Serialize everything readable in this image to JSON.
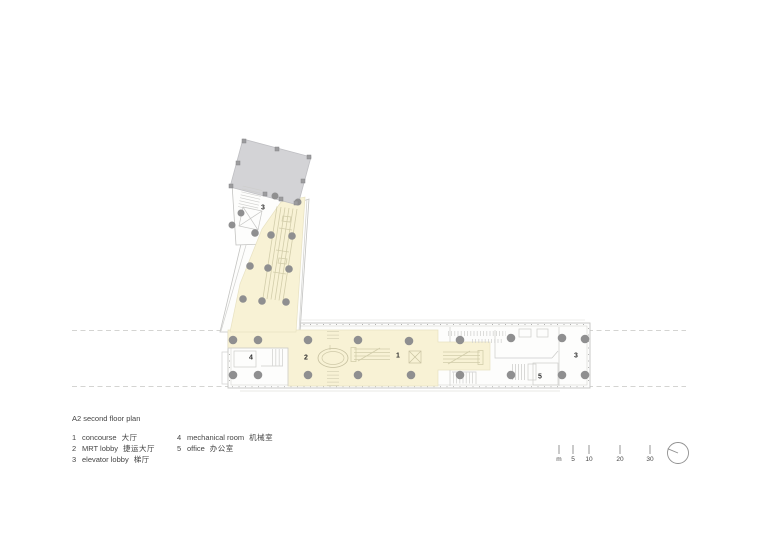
{
  "legend": {
    "title": "A2 second floor plan",
    "columns": [
      {
        "items": [
          {
            "num": "1",
            "en": "concourse",
            "zh": "大厅"
          },
          {
            "num": "2",
            "en": "MRT lobby",
            "zh": "捷运大厅"
          },
          {
            "num": "3",
            "en": "elevator lobby",
            "zh": "梯厅"
          }
        ]
      },
      {
        "items": [
          {
            "num": "4",
            "en": "mechanical room",
            "zh": "机械室"
          },
          {
            "num": "5",
            "en": "office",
            "zh": "办公室"
          }
        ]
      }
    ]
  },
  "plan": {
    "room_labels": {
      "concourse": "1",
      "mrt_lobby": "2",
      "elevator_lobby": "3",
      "mechanical_room": "4",
      "office": "5"
    },
    "colors": {
      "concourse_fill": "#f8f2d5",
      "roof_fill": "#d3d3d6",
      "column": "#8f8f90",
      "wall_line": "#c3c3c1",
      "detail_line": "#d2cdaa",
      "dashed_line": "#c6c6c4"
    }
  },
  "scale_bar": {
    "labels": [
      "m",
      "5",
      "10",
      "20",
      "30"
    ]
  },
  "icons": {
    "north_indicator": "north-arrow-icon"
  }
}
